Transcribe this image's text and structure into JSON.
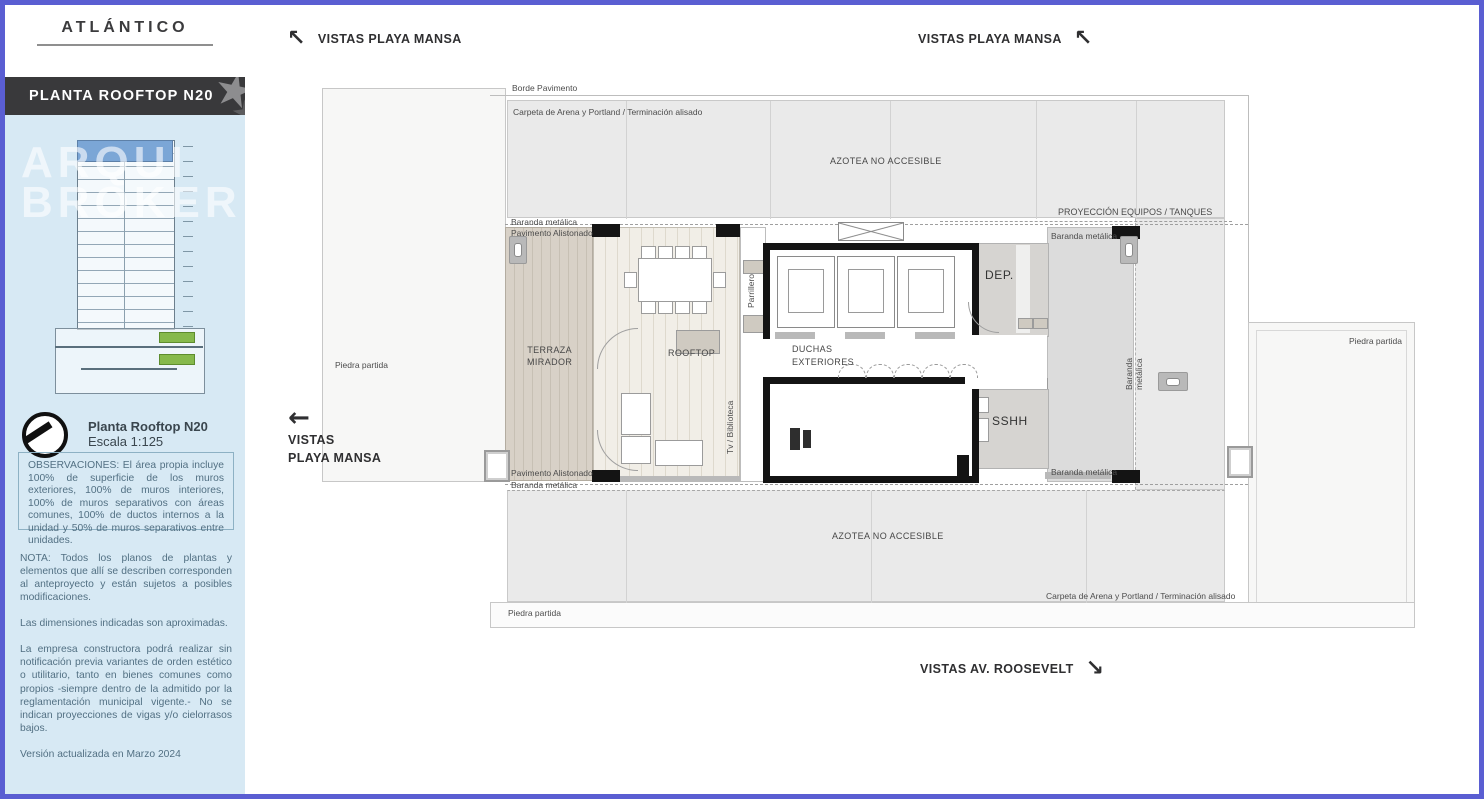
{
  "sidebar": {
    "brand": "ATLÁNTICO",
    "band_title": "PLANTA ROOFTOP N20",
    "watermark_line1": "ARQUI",
    "watermark_line2": "BROKER",
    "scale_title": "Planta Rooftop N20",
    "scale_value": "Escala 1:125",
    "observaciones": "OBSERVACIONES: El área propia incluye 100% de superficie de los muros exteriores, 100% de muros interiores, 100% de muros separativos con áreas comunes, 100% de ductos internos a la unidad y 50% de muros separativos entre unidades.",
    "nota": "NOTA: Todos los planos de plantas y elementos que allí se describen corresponden al anteproyecto y están sujetos a posibles modificaciones.",
    "dimensiones": "Las dimensiones indicadas son aproximadas.",
    "empresa": "La empresa constructora podrá realizar sin notificación previa variantes de orden estético o utilitario, tanto en bienes comunes como propios -siempre dentro de la admitido por la reglamentación municipal vigente.- No se indican proyecciones de vigas y/o cielorrasos bajos.",
    "version": "Versión actualizada en Marzo 2024"
  },
  "directions": {
    "top_left": "VISTAS PLAYA MANSA",
    "top_right": "VISTAS PLAYA MANSA",
    "left_line1": "VISTAS",
    "left_line2": "PLAYA MANSA",
    "bottom": "VISTAS AV. ROOSEVELT",
    "arrow_up_left": "↖",
    "arrow_left": "←",
    "arrow_down_right": "↘"
  },
  "plan": {
    "borde_pavimento": "Borde Pavimento",
    "carpeta": "Carpeta de Arena y Portland / Terminación alisado",
    "azotea": "AZOTEA NO ACCESIBLE",
    "proyeccion": "PROYECCIÓN EQUIPOS / TANQUES",
    "baranda": "Baranda metálica",
    "pavimento_alistonado": "Pavimento Alistonado",
    "terraza_line1": "TERRAZA",
    "terraza_line2": "MIRADOR",
    "rooftop": "ROOFTOP",
    "parrillero": "Parrillero",
    "tv_biblioteca": "Tv / Biblioteca",
    "duchas_line1": "DUCHAS",
    "duchas_line2": "EXTERIORES",
    "dep": "DEP.",
    "sshh": "SSHH",
    "piedra_partida": "Piedra partida"
  },
  "colors": {
    "frame_border": "#5a5ed2",
    "sidebar_bg": "#d7e9f4",
    "band_bg": "#39393b",
    "note_text": "#527083",
    "wall_black": "#141414",
    "azotea_gray": "#eaeaea"
  }
}
